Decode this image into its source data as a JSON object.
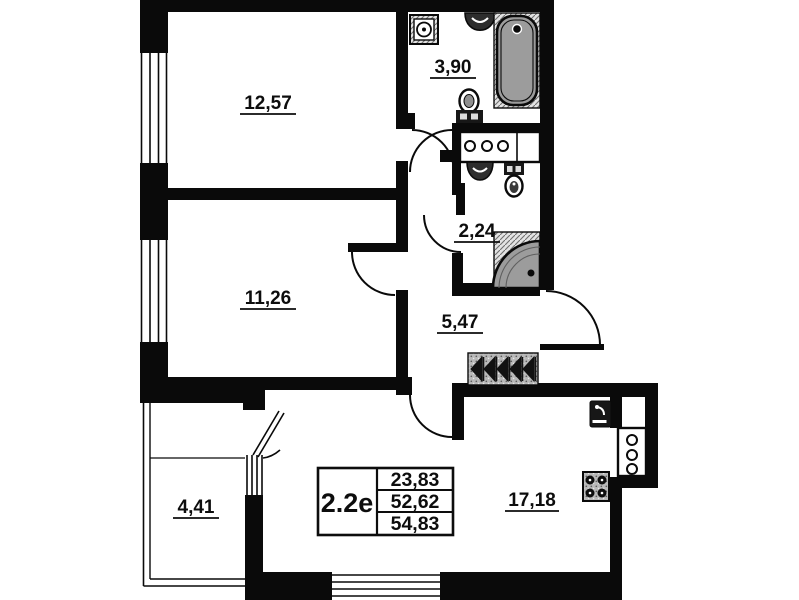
{
  "plan": {
    "rooms": [
      {
        "id": "bedroom-1",
        "area": "12,57"
      },
      {
        "id": "bathroom",
        "area": "3,90"
      },
      {
        "id": "bedroom-2",
        "area": "11,26"
      },
      {
        "id": "wc",
        "area": "2,24"
      },
      {
        "id": "hallway",
        "area": "5,47"
      },
      {
        "id": "balcony",
        "area": "4,41"
      },
      {
        "id": "kitchen-living",
        "area": "17,18"
      }
    ],
    "summary_table": {
      "type_label": "2.2e",
      "values": [
        "23,83",
        "52,62",
        "54,83"
      ]
    },
    "colors": {
      "wall": "#0a0a0a",
      "fixture_gray": "#9c9c9c",
      "hatch_gray": "#8a8a8a",
      "background": "#ffffff"
    }
  }
}
